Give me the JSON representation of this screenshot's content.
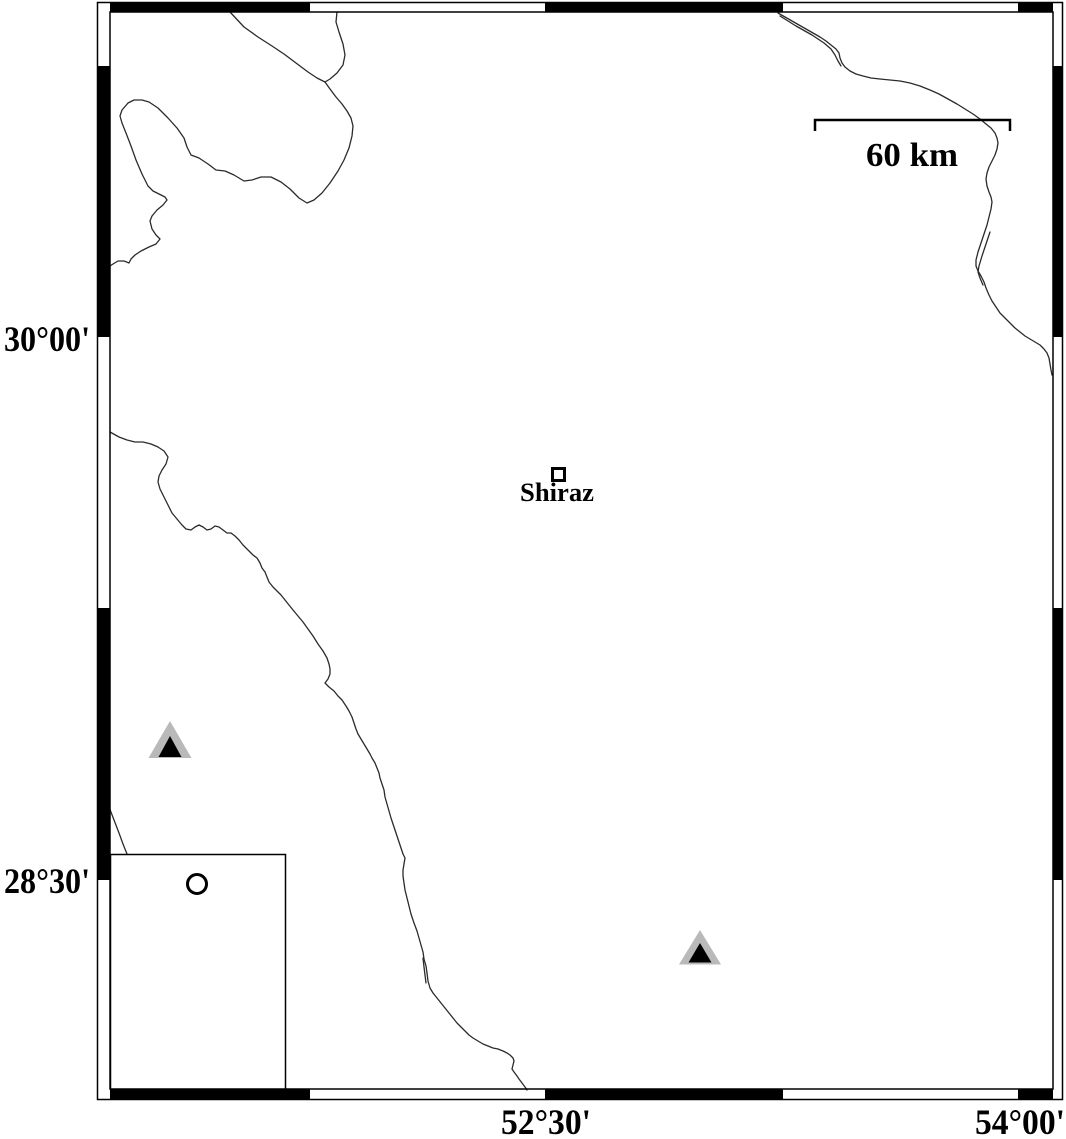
{
  "map": {
    "axes": {
      "left": [
        {
          "label": "30°00'"
        },
        {
          "label": "28°30'"
        }
      ],
      "bottom": [
        {
          "label": "52°30'"
        },
        {
          "label": "54°00'"
        }
      ]
    },
    "scale_bar": {
      "label": "60 km",
      "length_km": 60
    },
    "city": {
      "name": "Shiraz"
    },
    "markers": {
      "city_square": {
        "symbol": "open-square",
        "x": 558,
        "y": 474
      },
      "stations": [
        {
          "symbol": "triangle",
          "x": 170,
          "y": 745
        },
        {
          "symbol": "triangle",
          "x": 700,
          "y": 950
        }
      ],
      "event": {
        "symbol": "open-circle",
        "x": 197,
        "y": 884
      }
    },
    "inset_box": {
      "x": 110,
      "y": 854,
      "width": 175,
      "height": 235
    },
    "colors": {
      "background": "#ffffff",
      "frame": "#000000",
      "river": "#2b2b2b",
      "station_inner": "#000000",
      "station_outer": "#b9b9b9"
    }
  }
}
